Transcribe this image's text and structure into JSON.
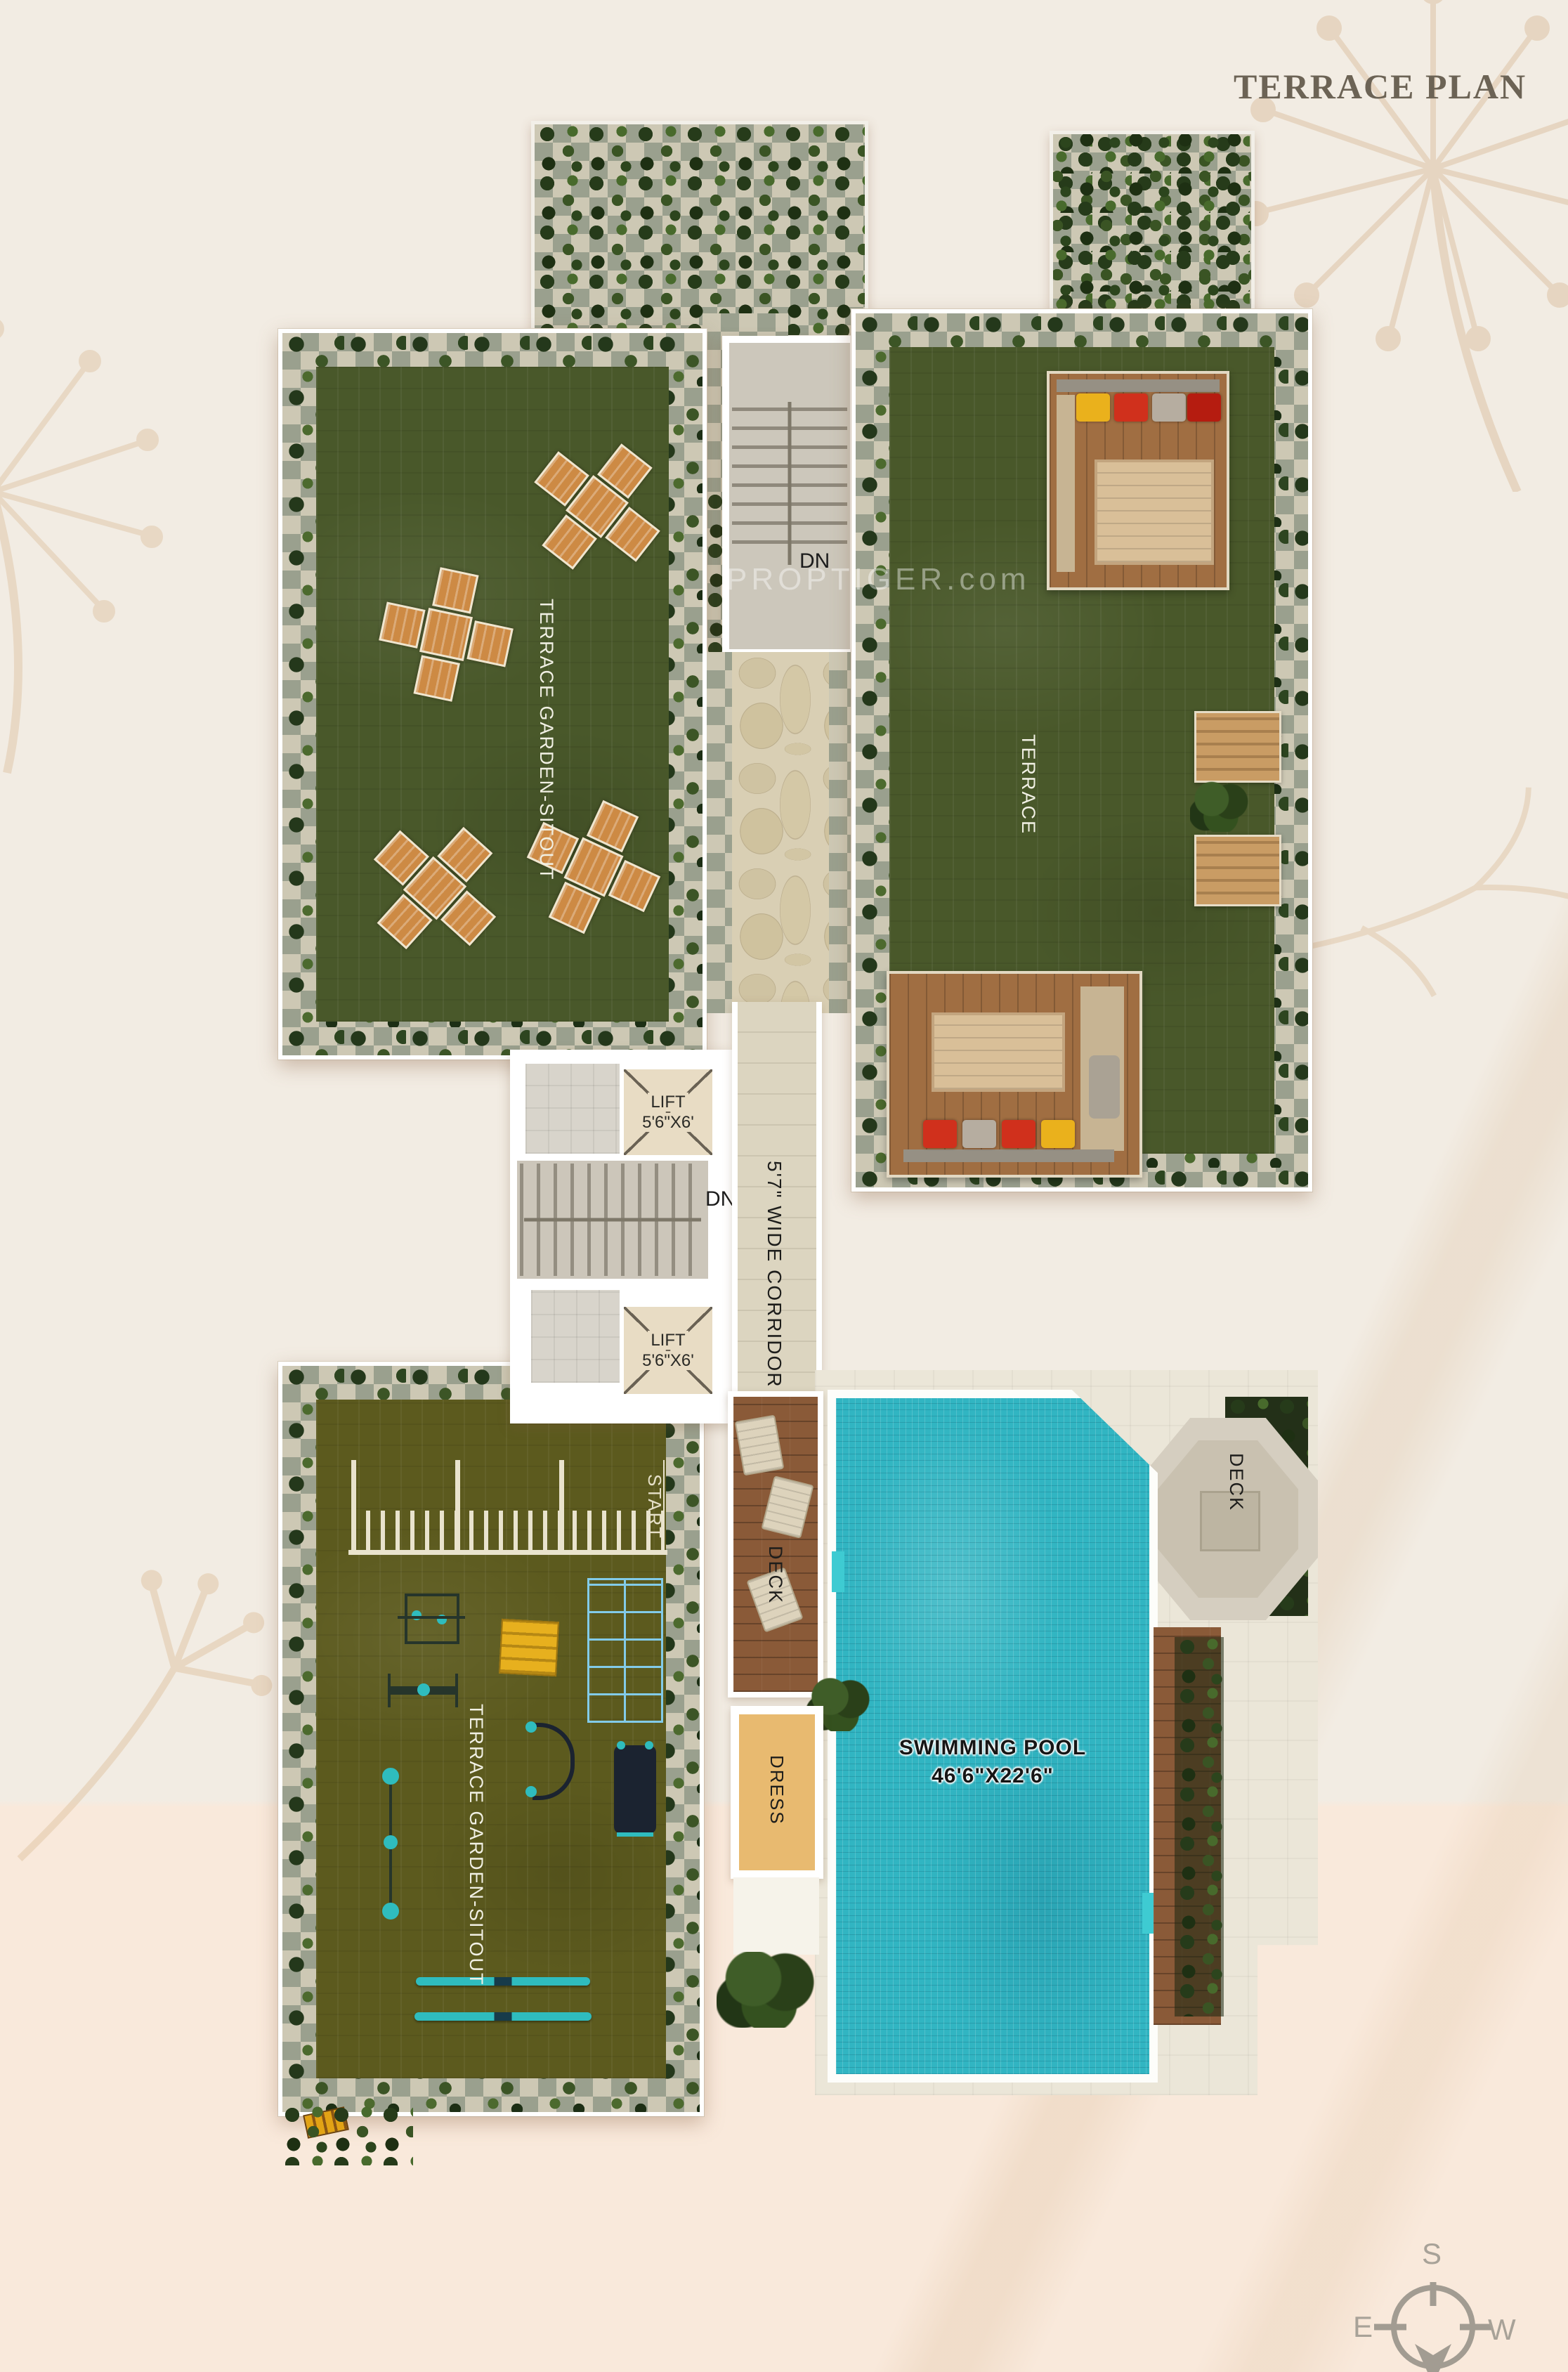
{
  "page": {
    "title": "TERRACE PLAN",
    "watermark": "PROPTIGER.com"
  },
  "upper_left_garden": {
    "label": "TERRACE GARDEN-SITOUT"
  },
  "upper_right_terrace": {
    "label": "TERRACE"
  },
  "stairs_top": {
    "down_label": "DN"
  },
  "core": {
    "lift_top": {
      "name": "LIFT",
      "size": "5'6\"X6'"
    },
    "lift_bottom": {
      "name": "LIFT",
      "size": "5'6\"X6'"
    },
    "stairs_down_label": "DN",
    "corridor_label": "5'7\" WIDE CORRIDOR"
  },
  "lower_left_garden": {
    "label": "TERRACE GARDEN-SITOUT",
    "track_start_label": "START"
  },
  "pool_area": {
    "left_deck_label": "DECK",
    "right_deck_label": "DECK",
    "dress_label": "DRESS",
    "pool_name": "SWIMMING POOL",
    "pool_size": "46'6\"X22'6\""
  },
  "compass": {
    "south": "S",
    "east": "E",
    "west": "W"
  },
  "colors": {
    "pool_water": "#35b9c5",
    "lawn_green": "#4a5a2b",
    "olive_lawn": "#5c5a1e",
    "title": "#6c6355"
  }
}
